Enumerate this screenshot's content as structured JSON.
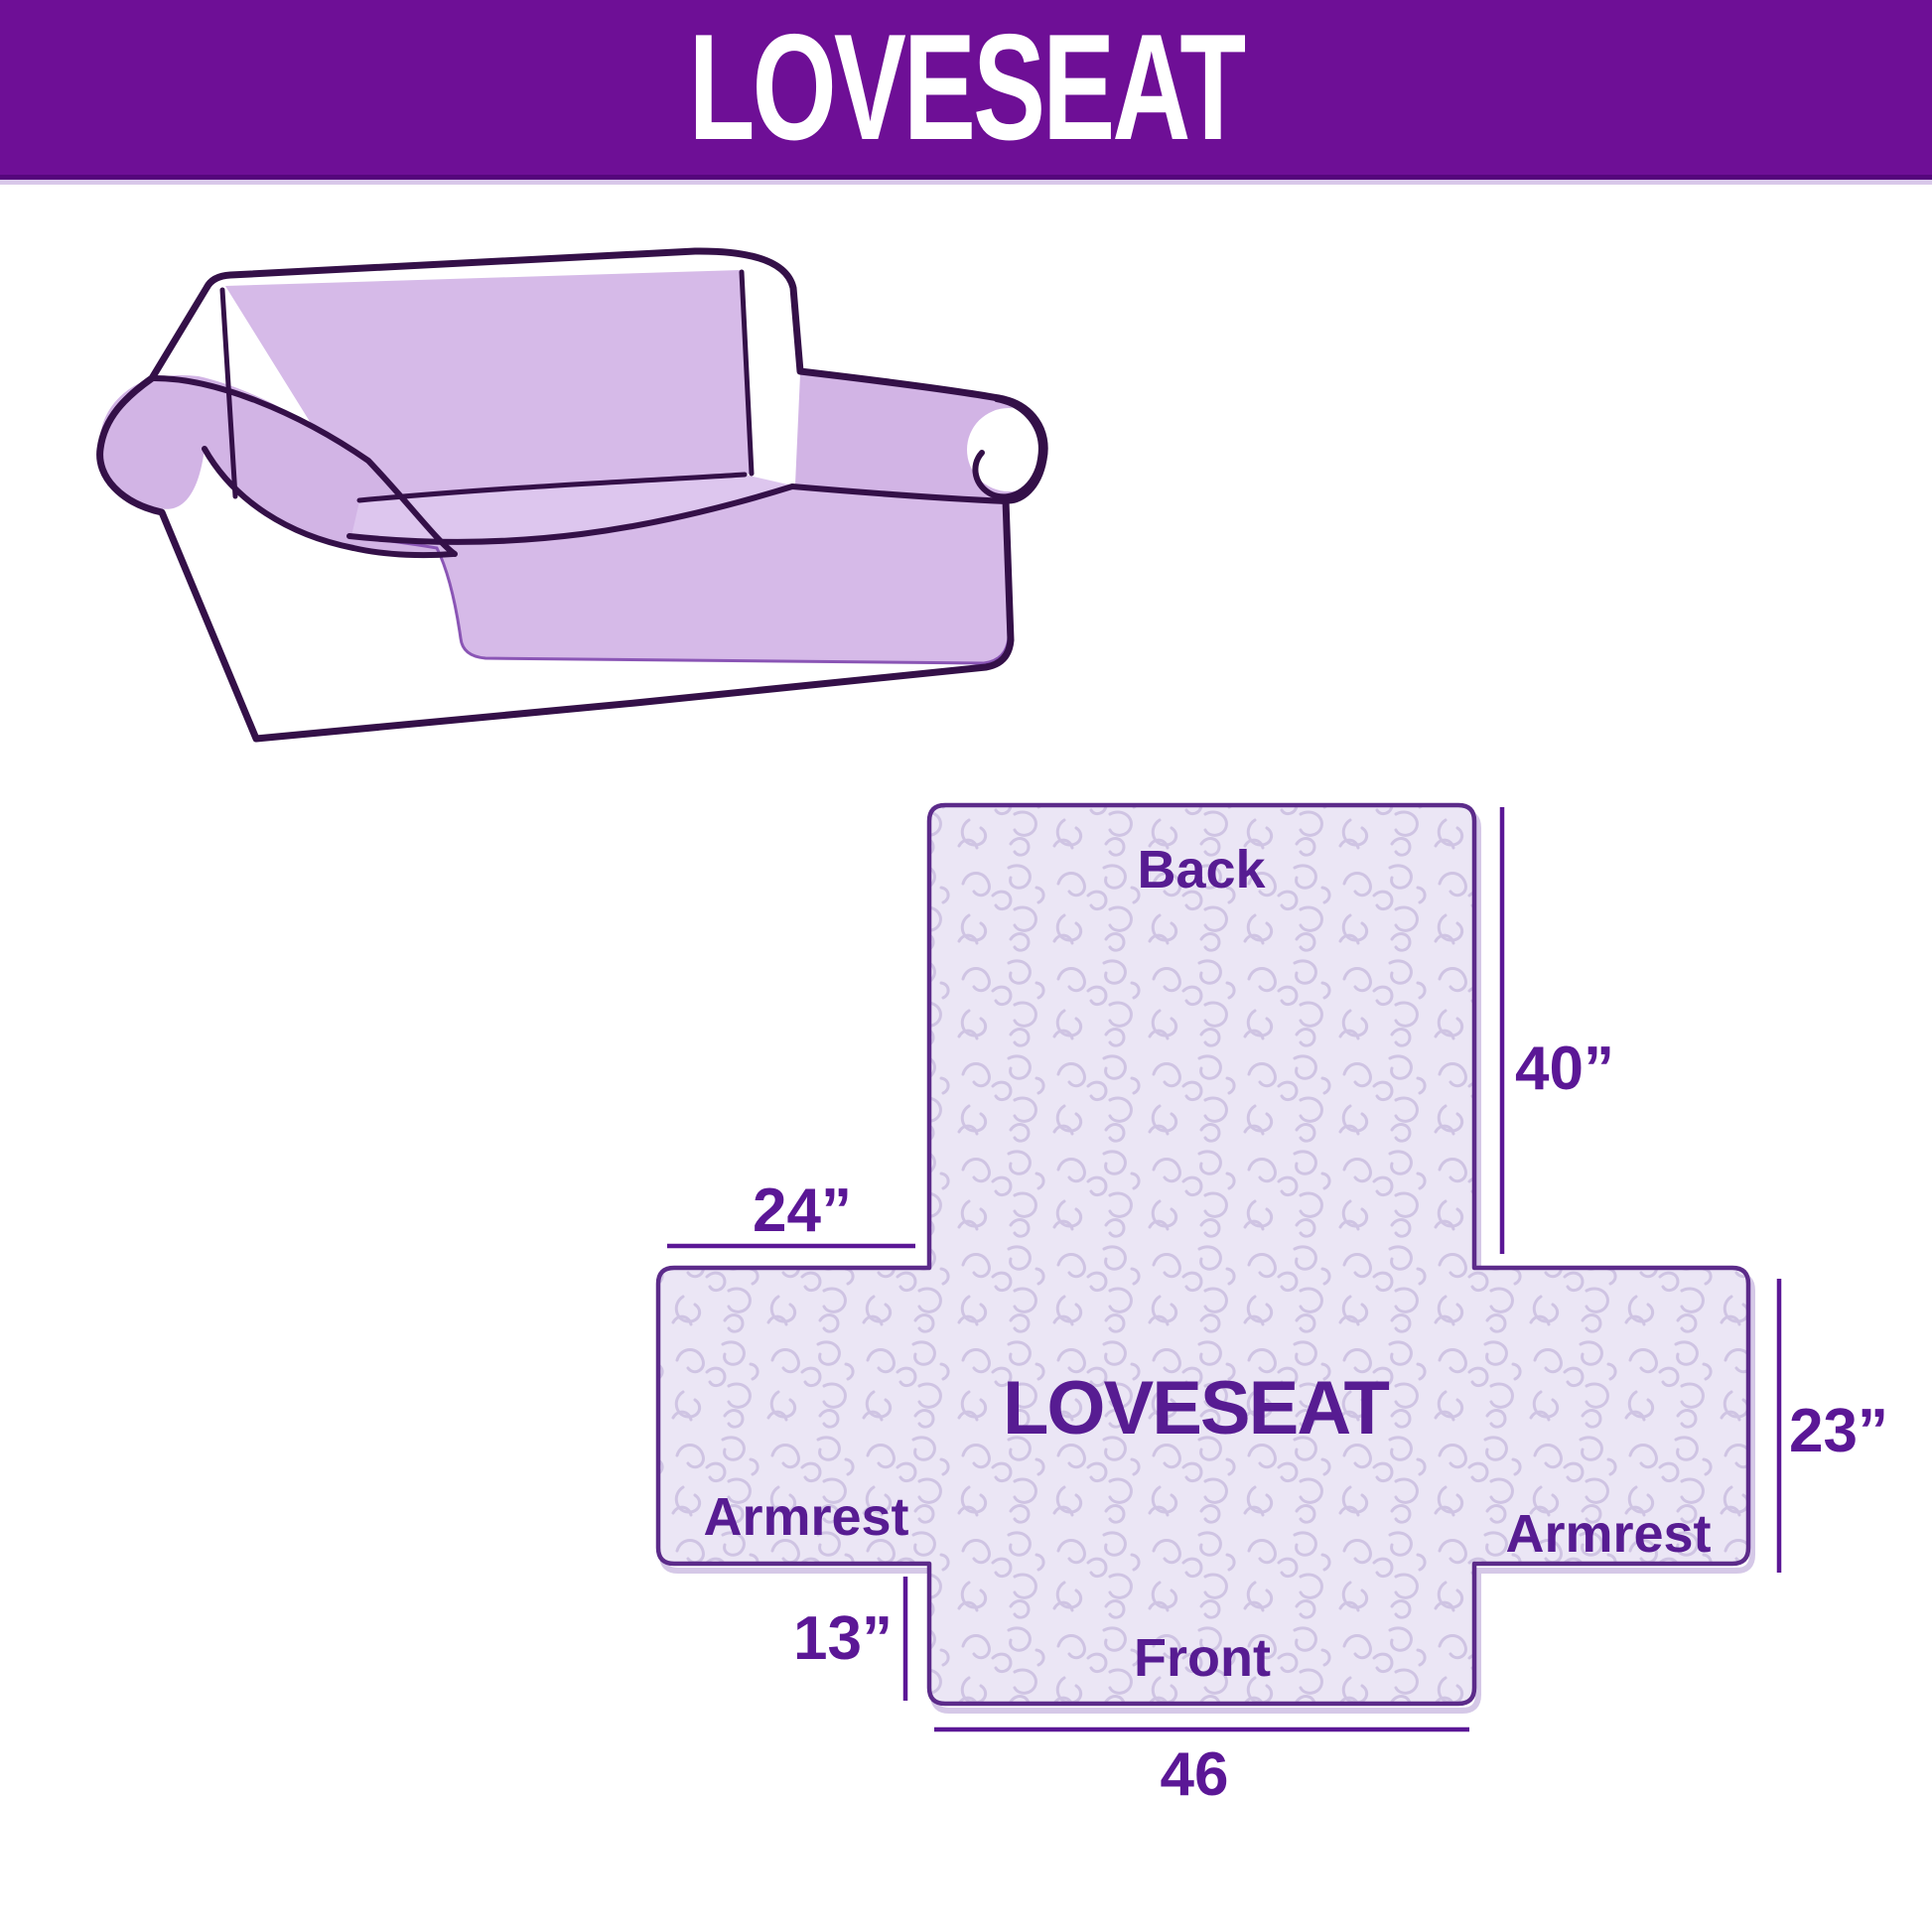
{
  "header": {
    "title": "LOVESEAT"
  },
  "sofa": {
    "description": "loveseat sofa line illustration with lavender slipcover"
  },
  "template": {
    "center_label": "LOVESEAT",
    "back_label": "Back",
    "front_label": "Front",
    "armrest_left_label": "Armrest",
    "armrest_right_label": "Armrest",
    "dimensions": {
      "back_height": "40”",
      "armrest_width": "24”",
      "armrest_height": "23”",
      "front_flap_height": "13”",
      "seat_width": "46"
    }
  },
  "colors": {
    "header_purple": "#6e0f96",
    "accent_purple": "#5b1796",
    "template_outline": "#5c2b8a",
    "template_fill": "#ebe6f5",
    "pattern_line": "#cfc4e3",
    "cover_lilac": "#d6bae8",
    "sofa_outline": "#341048"
  }
}
